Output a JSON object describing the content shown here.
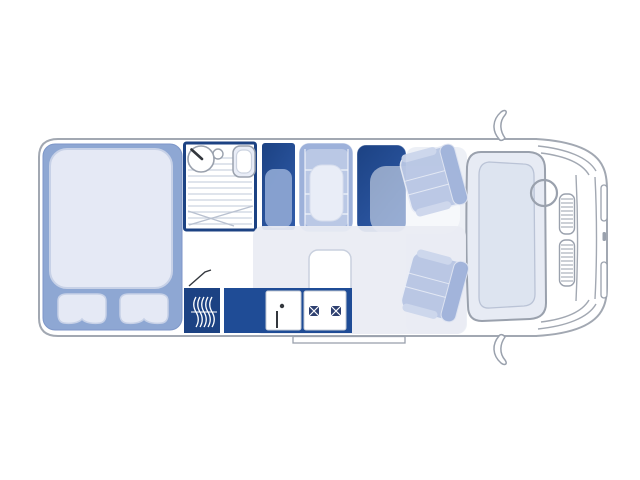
{
  "image": {
    "description": "Top-view floor plan of a coachbuilt motorhome / camper van",
    "width_px": 640,
    "height_px": 480
  },
  "palette": {
    "outline": "#a2a8b2",
    "navy": "#1c4283",
    "blue": "#2e59a6",
    "counter": "#1f4c96",
    "furn": "#8ea7d3",
    "furn-edge": "#7d96c8",
    "bench": "#9db1da",
    "bench-inner": "#bac8e5",
    "seat": "#b8c6e4",
    "seat-back": "#9fb2da",
    "armrest": "#ccd6ec",
    "mattress": "#e5e9f5",
    "mattress-edge": "#c7d1e7",
    "cushion": "#e9edf7",
    "cushion-edge": "#d6dded",
    "floor": "#e9ecf3",
    "cab-floor": "#edf0f6",
    "stripe": "#ccd3e0",
    "tray-line": "#b9c1d0",
    "fixture": "#9aa1ad",
    "dark": "#33373d",
    "glass": "#e7ebf4",
    "glass-inner": "#dde4f0",
    "glass-inner-edge": "#bac3d6",
    "wardrobe-inner": "#8ba4d2",
    "table-stroke": "#c9d0de",
    "panel-stroke": "#c6cbd6",
    "burner": "#2e4070",
    "white": "#ffffff"
  },
  "floorplan": {
    "vehicle": "motorhome-top-view",
    "rear_bedroom": {
      "furniture": "double-bed",
      "pillow_count": 2
    },
    "washroom": {
      "fixtures": [
        "washbasin",
        "toilet",
        "shower-floor"
      ]
    },
    "wardrobe": "wardrobe-cabinet",
    "dinette": {
      "bench": "travel-seat-bench",
      "table": "dinette-table"
    },
    "galley": {
      "units": [
        "sink-unit",
        "hob-unit"
      ],
      "hob_burner_count": 2,
      "heater": "heater-unit"
    },
    "cab": {
      "seats": [
        "driver-swivel-seat",
        "passenger-swivel-seat"
      ],
      "steering_wheel_count": 1,
      "side_mirror_count": 2,
      "grille_vent_count": 2,
      "headlight_count": 2
    },
    "entry_step_count": 1
  }
}
